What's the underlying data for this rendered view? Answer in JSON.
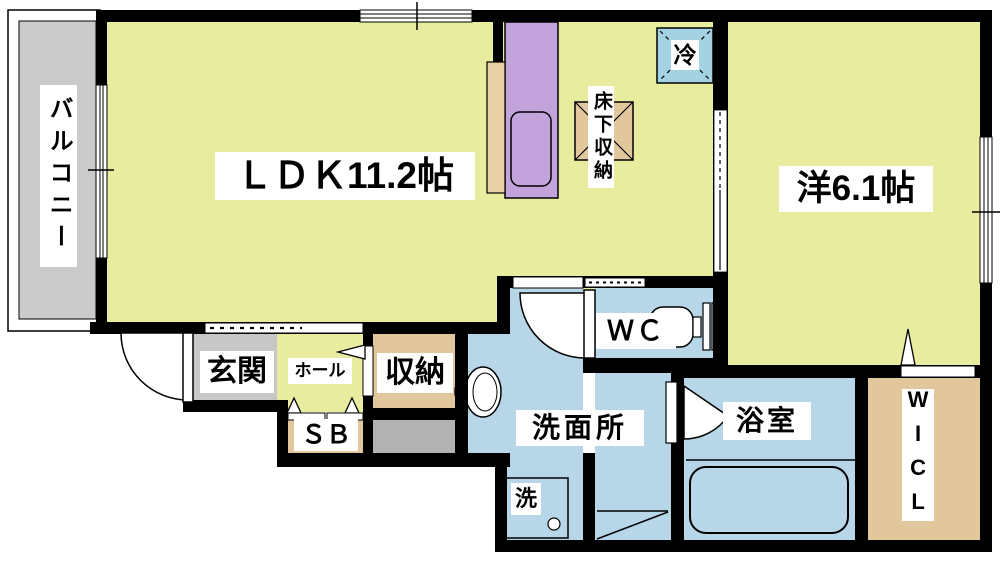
{
  "floorplan": {
    "labels": {
      "balcony": "バルコニー",
      "ldk": "ＬＤＫ11.2帖",
      "western_room": "洋6.1帖",
      "refrigerator": "冷",
      "underfloor_storage": "床下収納",
      "wc": "ＷＣ",
      "entrance": "玄関",
      "hall": "ホール",
      "storage": "収納",
      "shoe_box": "ＳＢ",
      "washroom": "洗面所",
      "washing_machine": "洗",
      "bathroom": "浴室",
      "walk_in_closet": "WICL"
    },
    "colors": {
      "wall": "#000000",
      "room_yellow": "#e8ec9f",
      "room_blue": "#b7d6e7",
      "fridge_blue": "#a4d2e2",
      "kitchen_purple": "#c3a3dc",
      "closet_tan": "#e2c69c",
      "counter_beige": "#e9cfa4",
      "entrance_gray": "#c7c7c7",
      "porch_gray": "#b2b2b2",
      "balcony_gray": "#cbcbcb",
      "background": "#ffffff",
      "fixture_white": "#ffffff"
    }
  }
}
